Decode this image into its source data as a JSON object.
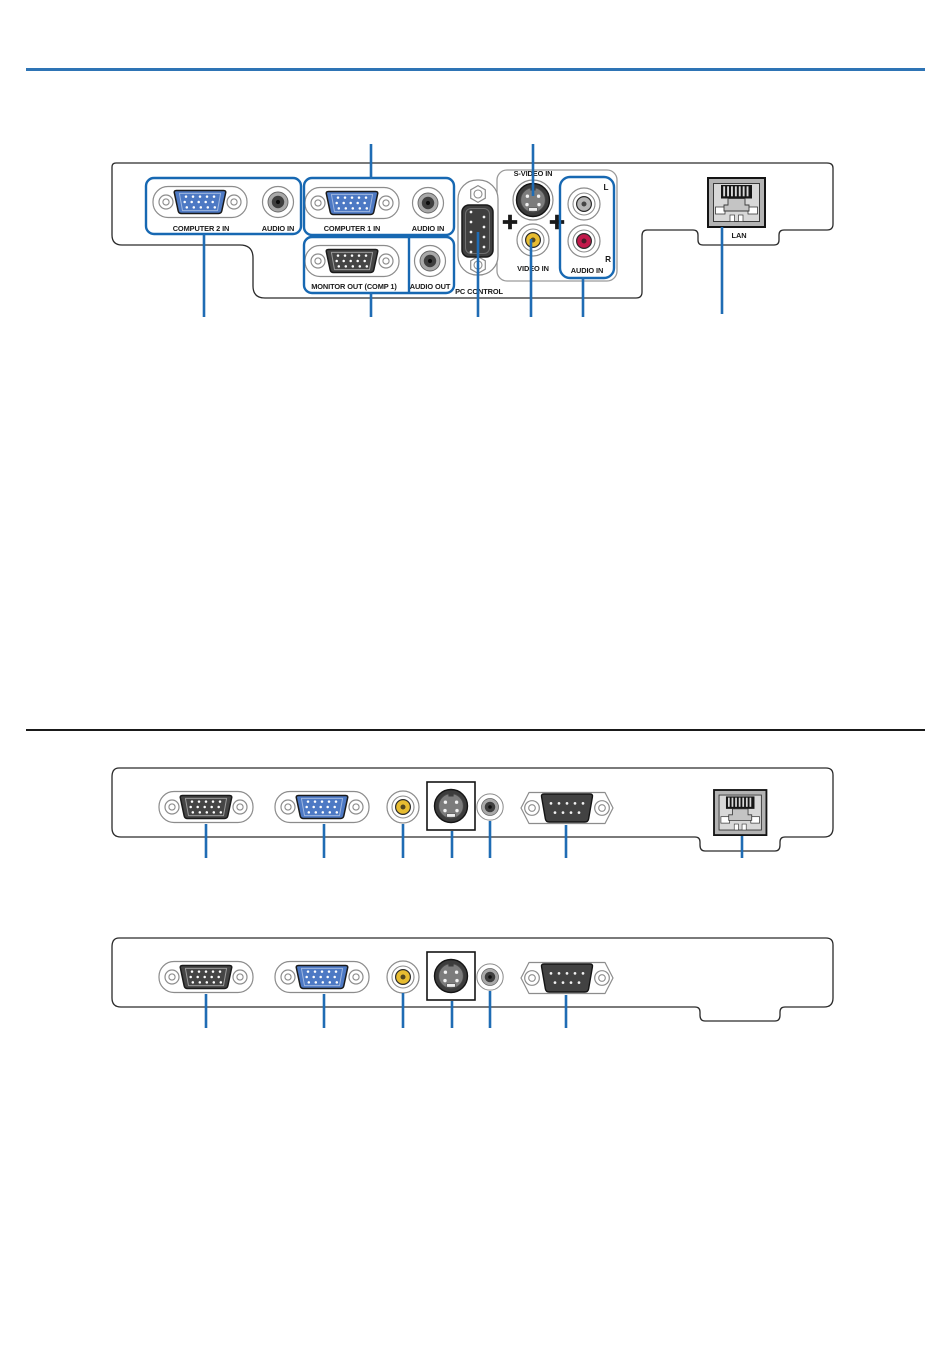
{
  "page": {
    "background": "#ffffff",
    "accent_rule_color": "#2e74b5",
    "divider_rule_color": "#1a1a1a",
    "leader_line_color": "#1f6cb4",
    "group_outline_color": "#1768b2",
    "vga_blue": "#4d79c4",
    "connector_dark": "#454545",
    "video_yellow": "#e7bc31",
    "audio_red": "#c2194b",
    "audio_left_gray": "#b5b5b5"
  },
  "labeled_panel": {
    "computer2_group": {
      "label": "COMPUTER 2 IN",
      "audio_label": "AUDIO IN"
    },
    "computer1_group": {
      "label": "COMPUTER 1 IN",
      "audio_label": "AUDIO IN"
    },
    "monitor_out_group": {
      "label": "MONITOR OUT (COMP 1)",
      "audio_label": "AUDIO OUT"
    },
    "pc_control_label": "PC CONTROL",
    "s_video_label": "S-VIDEO IN",
    "video_label": "VIDEO IN",
    "audio_lr_group": {
      "left_label": "L",
      "right_label": "R",
      "label": "AUDIO IN"
    },
    "lan_label": "LAN"
  },
  "icons": {
    "vga_connector": "15-pin VGA D-sub",
    "audio_minijack": "audio mini jack",
    "rca_jack": "RCA jack",
    "s_video_connector": "4-pin mini-DIN",
    "serial_9pin": "9-pin D-sub serial",
    "rj45_port": "RJ45 LAN port",
    "screw": "phillips screw"
  }
}
